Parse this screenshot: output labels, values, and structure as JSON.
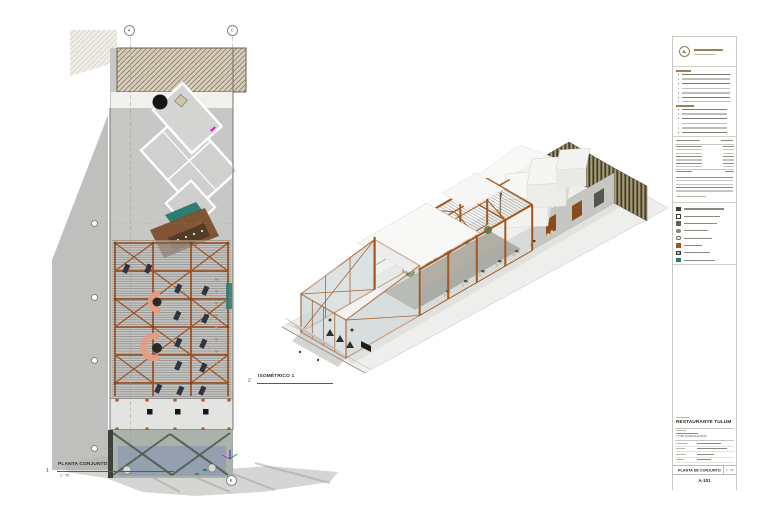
{
  "sheet": {
    "background": "#ffffff",
    "type": "architectural-sheet"
  },
  "plan_view": {
    "number": "1",
    "title": "PLANTA CONJUNTO",
    "scale": "1 : 75",
    "grid_top": [
      "A",
      "C"
    ],
    "grid_bottom": "B"
  },
  "iso_view": {
    "number": "2",
    "title": "ISOMÉTRICO 1"
  },
  "title_block": {
    "project_title": "RESTAURANTE TULUM",
    "address_line": "77760 QUINTANA ROO",
    "sheet_name": "PLANTA DE CONJUNTO",
    "scale_value": "1 : 75",
    "sheet_number": "A-101"
  },
  "colors": {
    "steel_orange": "#a4561e",
    "salmon": "#e59c85",
    "teal": "#2e7d74",
    "shadow_gray": "#b4b4b2",
    "slat_brown": "#6b6242",
    "accent_gold": "#9a8352"
  }
}
